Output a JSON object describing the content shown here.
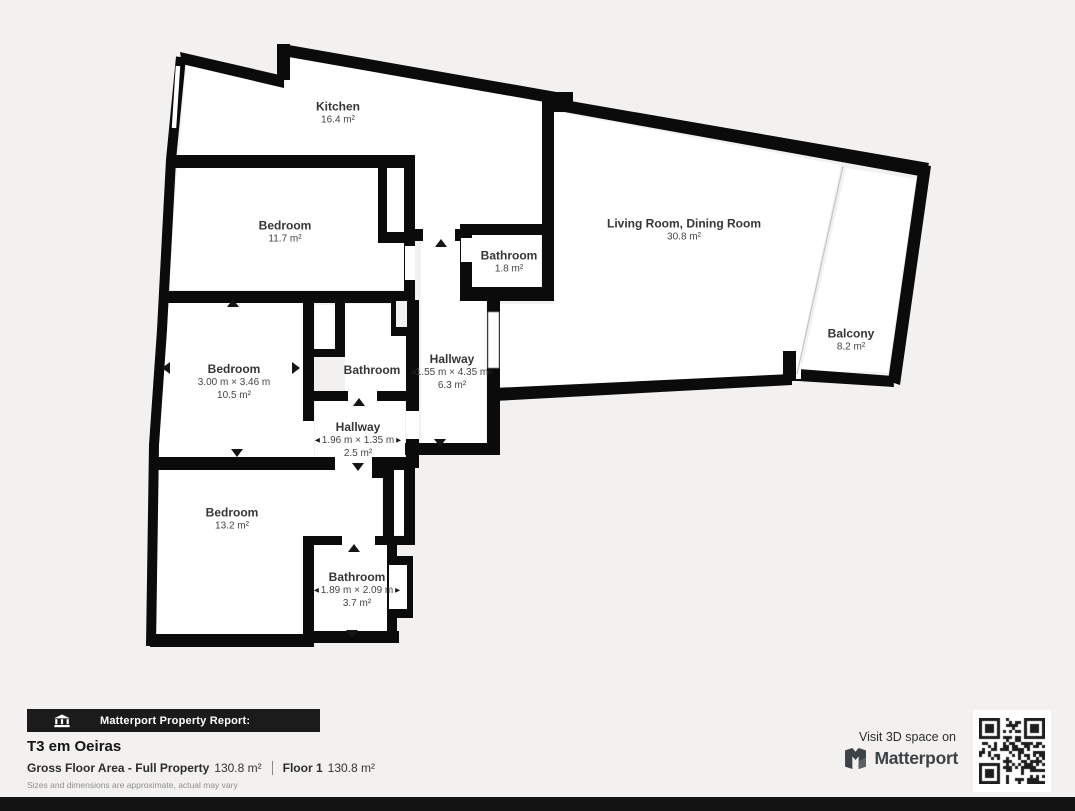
{
  "floor_plan": {
    "rooms": {
      "kitchen": {
        "name": "Kitchen",
        "area": "16.4 m²"
      },
      "bedroom_top": {
        "name": "Bedroom",
        "area": "11.7 m²"
      },
      "bathroom_top": {
        "name": "Bathroom",
        "area": "1.8 m²"
      },
      "living_room": {
        "name": "Living Room, Dining Room",
        "area": "30.8 m²"
      },
      "balcony": {
        "name": "Balcony",
        "area": "8.2 m²"
      },
      "bedroom_mid": {
        "name": "Bedroom",
        "dims": "3.00 m × 3.46 m",
        "area": "10.5 m²"
      },
      "bathroom_mid": {
        "name": "Bathroom"
      },
      "hallway_main": {
        "name": "Hallway",
        "dims": "1.55 m × 4.35 m",
        "area": "6.3 m²"
      },
      "hallway_small": {
        "name": "Hallway",
        "dims": "1.96 m × 1.35 m",
        "area": "2.5 m²"
      },
      "bedroom_bottom": {
        "name": "Bedroom",
        "area": "13.2 m²"
      },
      "bathroom_bottom": {
        "name": "Bathroom",
        "dims": "1.89 m × 2.09 m",
        "area": "3.7 m²"
      }
    }
  },
  "footer": {
    "report_label": "Matterport Property Report:",
    "property_title": "T3 em Oeiras",
    "gross_floor_area_label": "Gross Floor Area - Full Property",
    "gross_floor_area_value": "130.8 m²",
    "floor_label": "Floor 1",
    "floor_value": "130.8 m²",
    "disclaimer": "Sizes and dimensions are approximate, actual may vary"
  },
  "branding": {
    "visit_text": "Visit 3D space on",
    "brand_name": "Matterport"
  },
  "colors": {
    "wall": "#0b0b0b",
    "floor": "#ffffff",
    "background": "#f2f1ef",
    "report_bar": "#1b1b1b",
    "bottom_bar": "#131313"
  }
}
